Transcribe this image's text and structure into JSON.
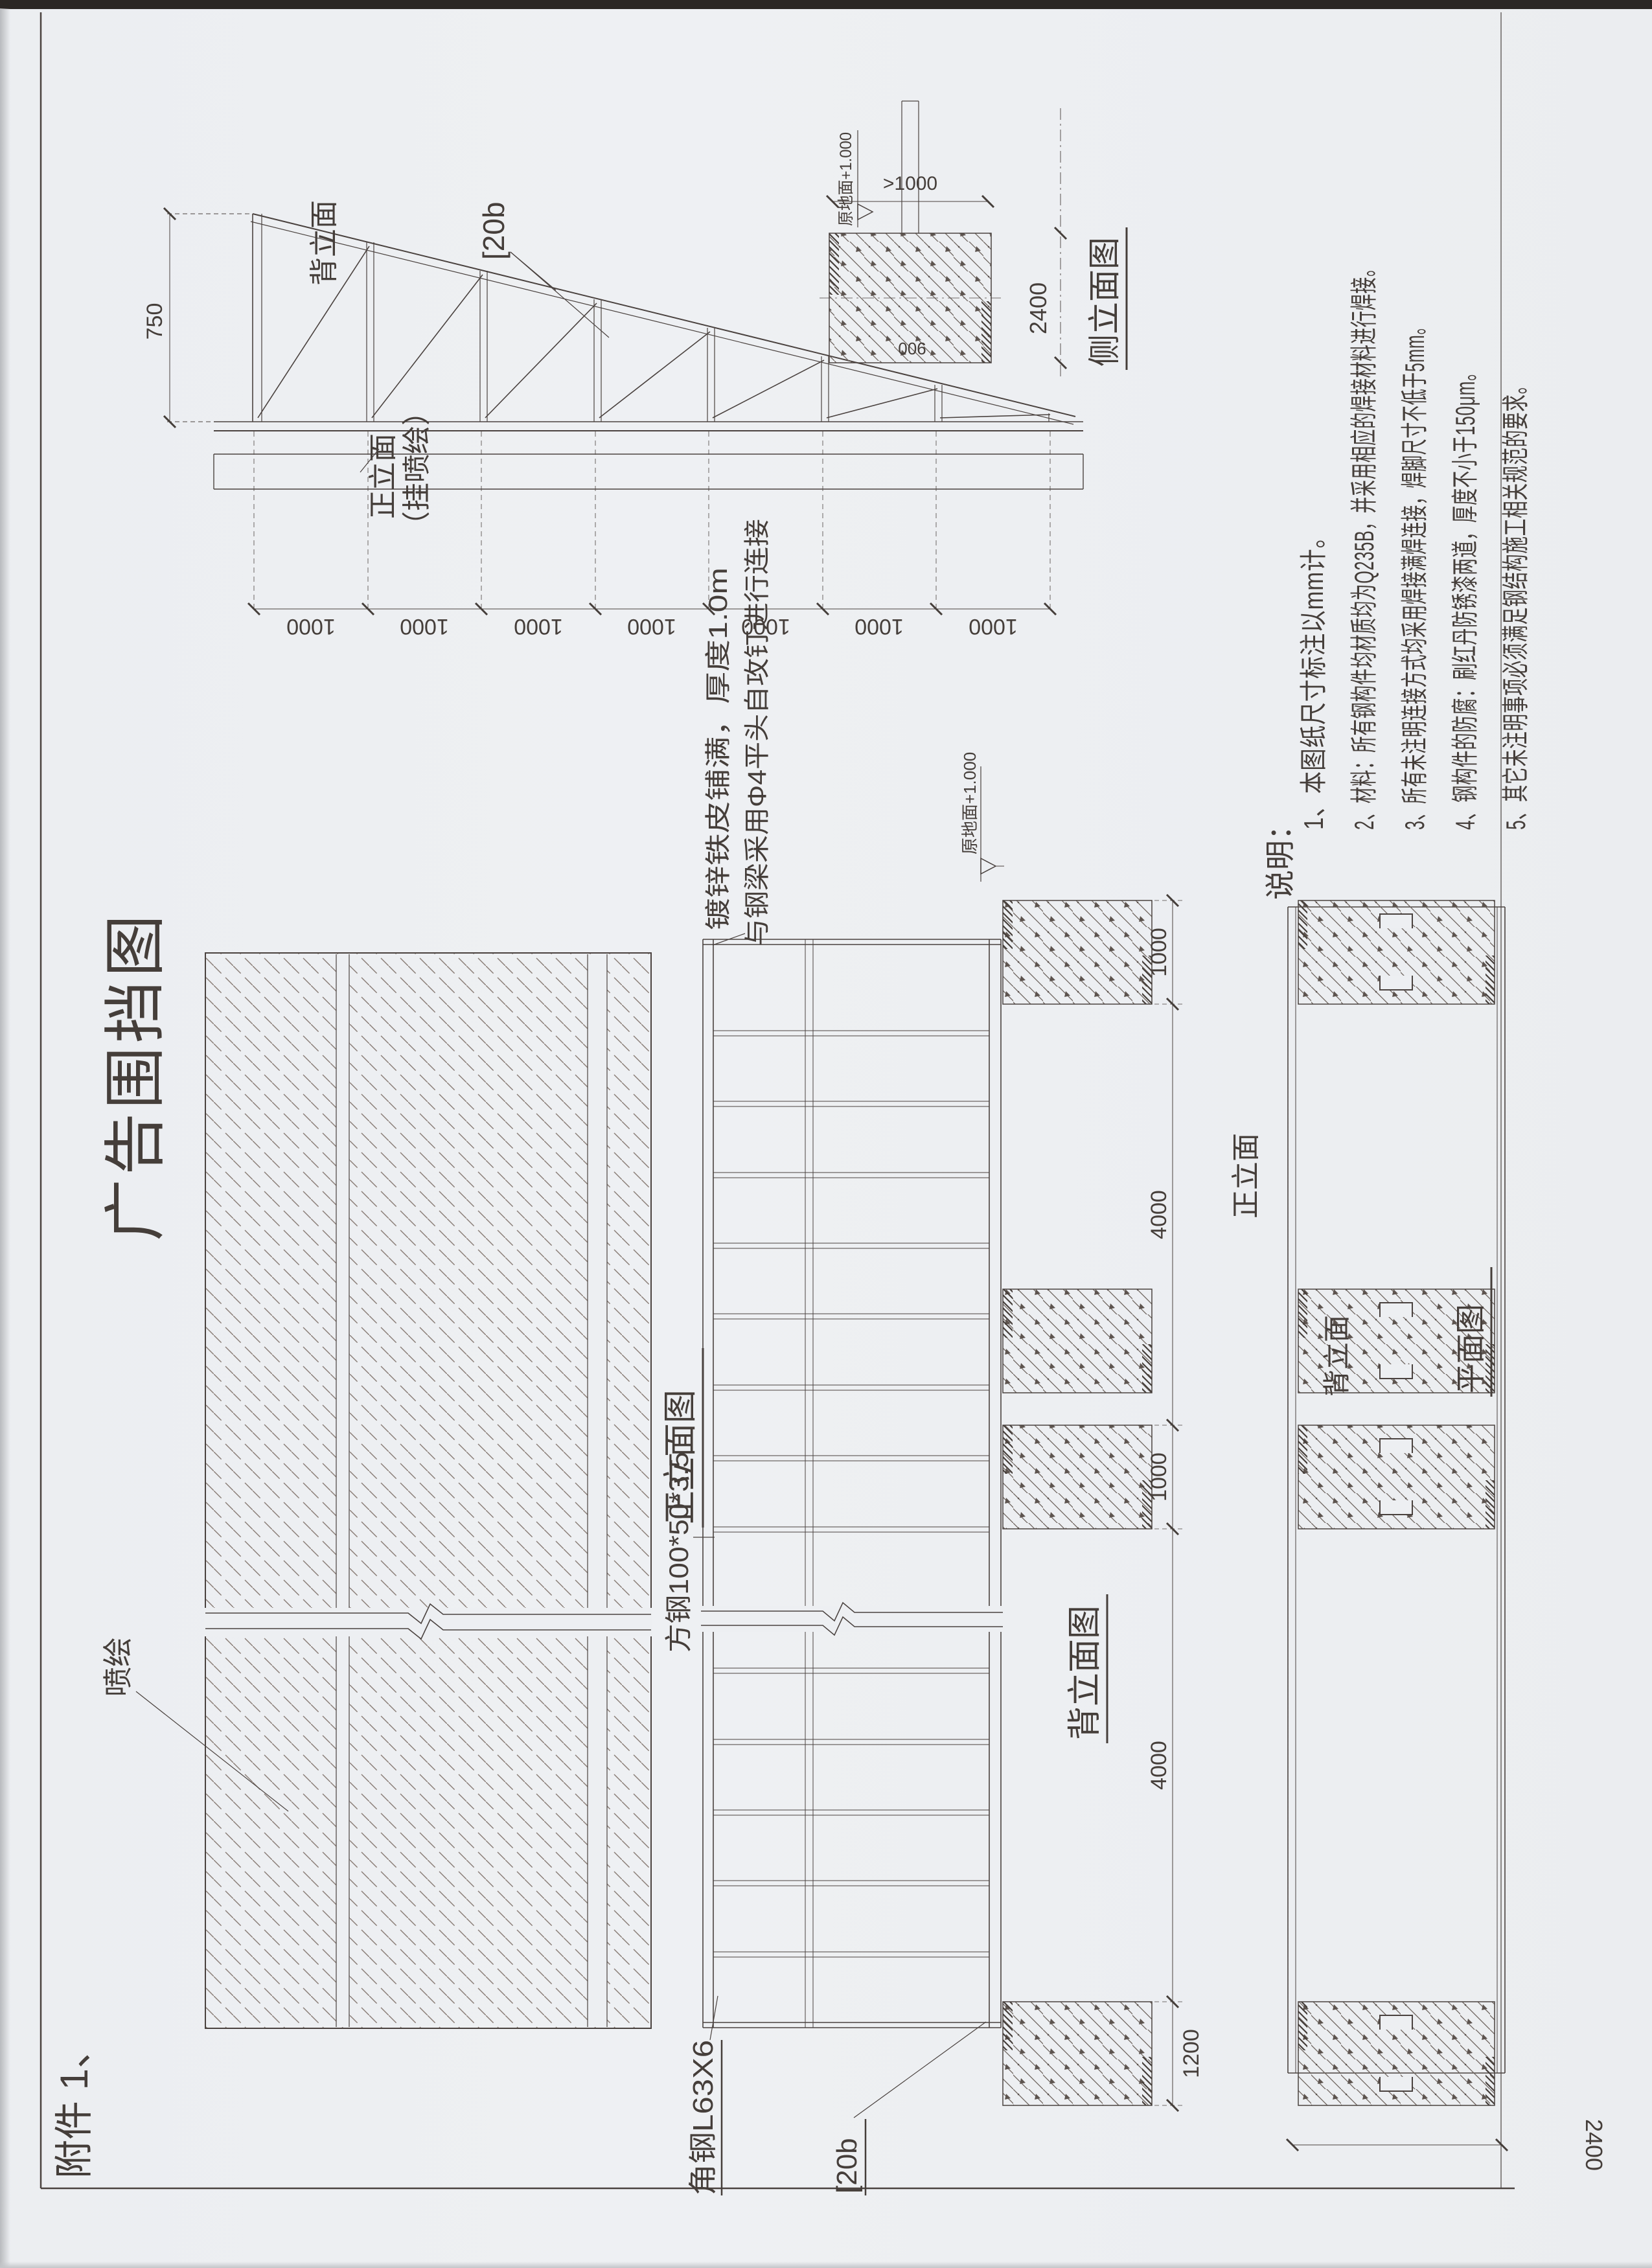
{
  "page": {
    "attachment": "附件 1、",
    "title": "广告围挡图",
    "paper_color": "#edeff2",
    "ink_color": "#4a423f",
    "scan_edge_color": "#2b2724"
  },
  "notes": {
    "heading": "说明：",
    "items": [
      "1、本图纸尺寸标注以mm计。",
      "2、材料：所有钢构件均材质均为Q235B，并采用相应的焊接材料进行焊接。",
      "3、所有未注明连接方式均采用焊接满焊连接，焊脚尺寸不低于5mm。",
      "4、钢构件的防腐：刷红丹防锈漆两道，厚度不小于150μm。",
      "5、其它未注明事项必须满足钢结构施工相关规范的要求。"
    ]
  },
  "front_view": {
    "title": "正立面图",
    "spray_label": "喷绘"
  },
  "back_view": {
    "title": "背立面图",
    "front_label": "正立面",
    "square_tube_label": "方钢100*50*3.5",
    "angle_label": "角钢L63X6",
    "channel_label": "[20b",
    "sheet_note_1": "镀锌铁皮铺满，厚度1.0m",
    "sheet_note_2": "与钢梁采用Φ4平头自攻钉进行连接",
    "level_label": "原地面+1.000",
    "dims": [
      "1200",
      "4000",
      "1000",
      "4000",
      "1000"
    ]
  },
  "truss_view": {
    "channel_label": "[20b",
    "back_label": "背立面",
    "front_label_1": "正立面",
    "front_label_2": "（挂喷绘）",
    "height_dim": "750",
    "span_dims": [
      "1000",
      "1000",
      "1000",
      "1000",
      "1000",
      "1000",
      "1000"
    ]
  },
  "side_view": {
    "title": "侧立面图",
    "level_label": "原地面+1.000",
    "depth_dim": ">1000",
    "height_dim": "2400",
    "width_dim": "900"
  },
  "plan_view": {
    "title": "平面图",
    "back_label": "背立面",
    "width_dim": "2400"
  }
}
